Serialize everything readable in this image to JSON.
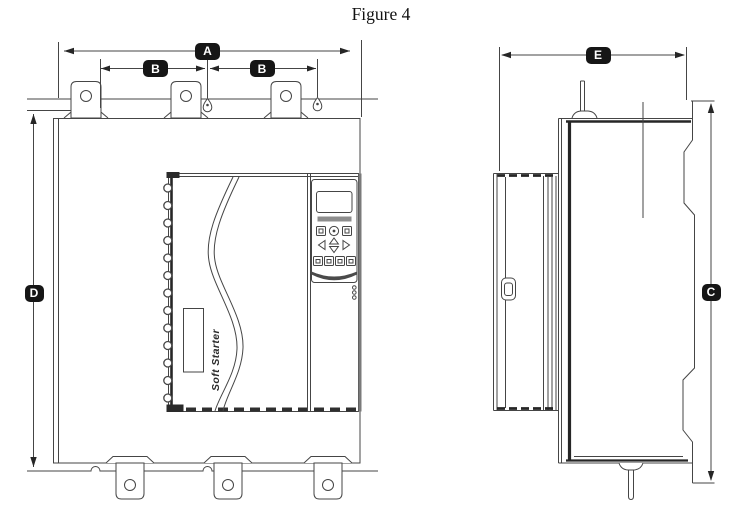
{
  "title": "Figure 4",
  "device": {
    "brand_label": "Soft Starter"
  },
  "dimensions": {
    "a": "A",
    "b1": "B",
    "b2": "B",
    "c": "C",
    "d": "D",
    "e": "E"
  },
  "colors": {
    "line": "#454545",
    "dark": "#262626",
    "badge_bg": "#161616",
    "badge_text": "#ffffff",
    "background": "#ffffff"
  }
}
